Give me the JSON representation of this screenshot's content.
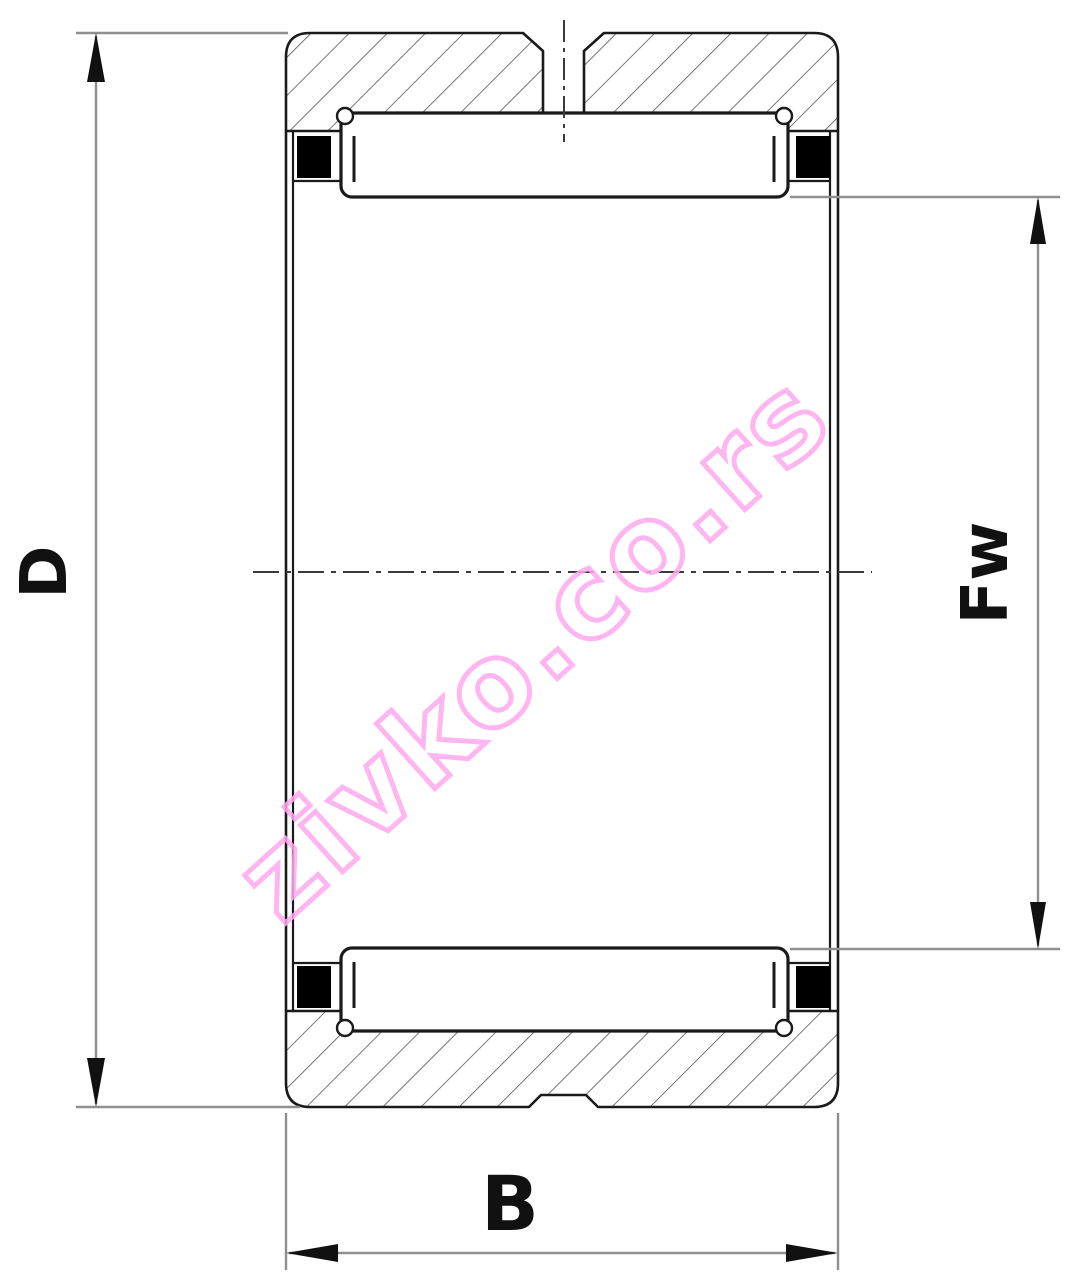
{
  "drawing": {
    "type": "needle-roller-bearing-cross-section",
    "labels": {
      "outer_diameter": "D",
      "bore_diameter": "Fw",
      "width": "B"
    },
    "watermark": {
      "text": "zivko.co.rs",
      "color": "#ffaaee"
    },
    "colors": {
      "background": "#ffffff",
      "line": "#1a1a1a",
      "dimension_line": "#8f8f8f",
      "arrow": "#111111",
      "hatch": "#4a4a4a",
      "seal": "#000000",
      "centerline": "#3a3a3a"
    }
  }
}
